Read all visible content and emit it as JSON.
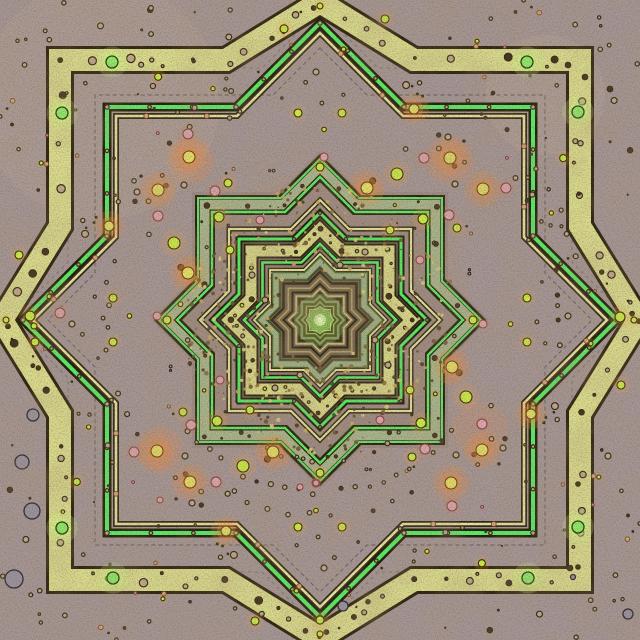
{
  "artwork": {
    "kind": "fractal-star-mandala",
    "canvas": {
      "width": 640,
      "height": 640,
      "background": "#a69797",
      "center": [
        320,
        320
      ]
    },
    "palette": {
      "band_yellow": "#dcdd8f",
      "band_dark_edge": "#2e2410",
      "stripe_green": "#58f168",
      "stripe_pale": "#e9e7a5",
      "sage_band": "#aab78f",
      "faint_line": "rgba(70,58,48,0.5)",
      "core_glow": "#cdf39a",
      "grain_dark": "#1a140a",
      "blotch_brown": "#6b4c2e"
    },
    "glow_patches": [
      [
        450,
        160,
        24,
        "rgba(255,140,60,0.20)"
      ],
      [
        190,
        160,
        24,
        "rgba(255,140,60,0.20)"
      ],
      [
        160,
        450,
        24,
        "rgba(255,140,60,0.18)"
      ],
      [
        480,
        430,
        28,
        "rgba(255,140,60,0.15)"
      ],
      [
        320,
        320,
        150,
        "rgba(200,150,100,0.10)"
      ],
      [
        100,
        100,
        120,
        "rgba(225,205,170,0.10)"
      ],
      [
        545,
        95,
        60,
        "rgba(235,215,180,0.10)"
      ]
    ],
    "tint_fills": [
      {
        "s": 128,
        "r": 169,
        "fill": "rgba(115,92,66,0.16)"
      },
      {
        "s": 78,
        "r": 103,
        "fill": "rgba(105,82,58,0.20)"
      },
      {
        "s": 40,
        "r": 53,
        "fill": "rgba(62,50,28,0.33)"
      }
    ],
    "faint_layers": [
      {
        "s": 225,
        "r": 272,
        "strokes": [
          [
            "rgba(70,58,48,0.5)",
            1.2
          ]
        ],
        "dash": "4 3"
      },
      {
        "s": 252,
        "r": 310,
        "strokes": [
          [
            "rgba(70,58,48,0.35)",
            1.1
          ]
        ],
        "dash": "3 4"
      }
    ],
    "layers": [
      {
        "id": "outer-yellow-band",
        "s": 260,
        "r": 318,
        "w": 94,
        "strokes": [
          [
            "#2e2410",
            28
          ],
          [
            "#dcdd8f",
            22
          ]
        ],
        "banddots": {
          "perEdge": 3,
          "rMin": 1.5,
          "rMax": 4.5
        }
      },
      {
        "id": "green-stripe-1",
        "s": 213,
        "r": 297,
        "strokes": [
          [
            "#1f1c09",
            9
          ],
          [
            "#58f168",
            4
          ]
        ],
        "ticks": "tan"
      },
      {
        "id": "pale-stripe-1",
        "s": 204,
        "r": 287,
        "strokes": [
          [
            "#2e2410",
            6
          ],
          [
            "#e9e7a5",
            2.6
          ]
        ],
        "ticks": "peach"
      },
      {
        "id": "sage-band-1",
        "s": 115,
        "r": 152,
        "strokes": [
          [
            "#2a2110",
            20
          ],
          [
            "#aab78f",
            15.5
          ]
        ],
        "banddots": {
          "perEdge": 1,
          "rMin": 1.4,
          "rMax": 2.6
        }
      },
      {
        "id": "sage-edge-out",
        "s": 122,
        "r": 161,
        "strokes": [
          [
            "rgba(30,28,9,0.8)",
            3.6
          ],
          [
            "#64e870",
            2
          ]
        ]
      },
      {
        "id": "sage-edge-in",
        "s": 108,
        "r": 143,
        "strokes": [
          [
            "#1f1c09",
            5
          ],
          [
            "#5df06a",
            2.4
          ]
        ]
      },
      {
        "id": "pale-stripe-2",
        "s": 91,
        "r": 120,
        "strokes": [
          [
            "#2e2410",
            5
          ],
          [
            "#e6e49e",
            2.2
          ]
        ]
      },
      {
        "id": "green-stripe-2",
        "s": 81,
        "r": 107,
        "strokes": [
          [
            "#1f1c09",
            7
          ],
          [
            "#55ef66",
            3
          ]
        ],
        "ticks": "tiny"
      },
      {
        "id": "yellow-band-2",
        "s": 69,
        "r": 91,
        "strokes": [
          [
            "#2a2110",
            15
          ],
          [
            "#d9d98a",
            11
          ]
        ],
        "banddots": {
          "perEdge": 2,
          "rMin": 0.9,
          "rMax": 2.0
        }
      },
      {
        "id": "green-stripe-3",
        "s": 57.5,
        "r": 76,
        "strokes": [
          [
            "#1f1c09",
            5.6
          ],
          [
            "#5df06a",
            2.6
          ]
        ]
      },
      {
        "id": "pale-stripe-3",
        "s": 50,
        "r": 66,
        "strokes": [
          [
            "#2e2410",
            4.4
          ],
          [
            "#e6e49e",
            1.9
          ]
        ]
      },
      {
        "id": "sage-band-2",
        "s": 44,
        "r": 58,
        "strokes": [
          [
            "#2a2110",
            9
          ],
          [
            "#a3b089",
            6
          ]
        ]
      },
      {
        "id": "sage2-edge-out",
        "s": 47.5,
        "r": 63,
        "strokes": [
          [
            "#4a6a30",
            1.5
          ]
        ]
      },
      {
        "id": "sage2-edge-in",
        "s": 40.5,
        "r": 53.5,
        "strokes": [
          [
            "#4a6a30",
            1.5
          ]
        ]
      }
    ],
    "core": {
      "s0": 36.5,
      "ratio": 0.868,
      "count": 22,
      "r_factor": 1.32,
      "cycle": [
        [
          "#3a2f15",
          2.4
        ],
        [
          "#b3a65c",
          1.6
        ],
        [
          "#30270f",
          2.1
        ],
        [
          "#d2c973",
          1.5
        ],
        [
          "#352b11",
          2.0
        ],
        [
          "#8ba06b",
          1.4
        ]
      ]
    },
    "core_glow": [
      [
        26,
        "rgba(150,205,95,0.30)"
      ],
      [
        13,
        "rgba(175,235,120,0.55)"
      ],
      [
        6,
        "#cdf39a"
      ],
      [
        2.5,
        "#edffd6"
      ]
    ],
    "dot_types": {
      "green_glow": {
        "fill": "#8fee68",
        "ring": "#23400e",
        "rw": 1.3,
        "glow": "rgba(210,255,130,0.40)",
        "gm": 2.6
      },
      "chartreuse": {
        "fill": "#cdef46",
        "ring": "#32280a",
        "rw": 1.1,
        "glow": "rgba(255,170,60,0.28)",
        "gm": 2.2
      },
      "yellow_glow": {
        "fill": "#e9e066",
        "ring": "#5a3c14",
        "rw": 1.0,
        "glow": "rgba(255,140,50,0.38)",
        "gm": 3.0
      },
      "pink": {
        "fill": "#dfa6ae",
        "ring": "#784040",
        "rw": 1.0,
        "glow": "rgba(255,120,80,0.16)",
        "gm": 1.9
      },
      "tan_ring": {
        "fill": "#c2ab8c",
        "ring": "#322714",
        "rw": 1.2
      },
      "peach": {
        "fill": "#dba87c",
        "ring": "#7a4a20",
        "rw": 0.9
      },
      "dark": {
        "fill": "#43321c",
        "ring": "#2a1d0c",
        "rw": 0.6
      },
      "gray": {
        "fill": "#9b93a0",
        "ring": "#2d2a32",
        "rw": 1.3
      }
    },
    "quad_dots": [
      [
        112,
        62,
        6,
        "green_glow"
      ],
      [
        527,
        62,
        6,
        "green_glow"
      ],
      [
        385,
        19,
        4,
        "chartreuse"
      ],
      [
        320,
        6,
        3,
        "chartreuse"
      ],
      [
        189,
        157,
        6,
        "yellow_glow"
      ],
      [
        450,
        158,
        6,
        "yellow_glow"
      ],
      [
        424,
        158,
        5,
        "pink"
      ],
      [
        449,
        215,
        5,
        "pink"
      ],
      [
        457,
        228,
        4,
        "chartreuse"
      ],
      [
        188,
        273,
        6,
        "yellow_glow"
      ],
      [
        157,
        316,
        4,
        "pink"
      ],
      [
        243,
        466,
        6,
        "chartreuse"
      ],
      [
        217,
        421,
        5,
        "chartreuse"
      ],
      [
        134,
        452,
        5,
        "pink"
      ],
      [
        531,
        414,
        5,
        "yellow_glow"
      ],
      [
        527,
        298,
        4,
        "chartreuse"
      ],
      [
        527,
        342,
        4,
        "chartreuse"
      ],
      [
        473,
        320,
        4,
        "chartreuse"
      ],
      [
        568,
        316,
        3,
        "tan_ring"
      ],
      [
        448,
        137,
        3,
        "tan_ring"
      ],
      [
        455,
        184,
        3,
        "tan_ring"
      ],
      [
        365,
        252,
        3,
        "tan_ring"
      ],
      [
        380,
        420,
        4,
        "pink"
      ],
      [
        410,
        390,
        4,
        "chartreuse"
      ],
      [
        300,
        375,
        3,
        "tan_ring"
      ]
    ],
    "solo_dots": [
      [
        620,
        317,
        5,
        "chartreuse"
      ],
      [
        30,
        316,
        5,
        "chartreuse"
      ],
      [
        34,
        326,
        3,
        "chartreuse"
      ],
      [
        35,
        342,
        4,
        "chartreuse"
      ],
      [
        320,
        620,
        4,
        "chartreuse"
      ],
      [
        22,
        462,
        7,
        "gray"
      ],
      [
        33,
        415,
        6,
        "gray"
      ],
      [
        32,
        511,
        8,
        "gray"
      ],
      [
        14,
        579,
        9,
        "gray"
      ],
      [
        628,
        614,
        5,
        "gray"
      ],
      [
        343,
        606,
        5,
        "gray"
      ],
      [
        60,
        313,
        5,
        "pink"
      ],
      [
        608,
        456,
        3,
        "tan_ring"
      ],
      [
        610,
        89,
        3,
        "dark"
      ],
      [
        568,
        65,
        3,
        "dark"
      ],
      [
        585,
        77,
        3,
        "dark"
      ],
      [
        570,
        568,
        3,
        "dark"
      ],
      [
        578,
        567,
        2.5,
        "dark"
      ],
      [
        573,
        577,
        2.5,
        "gray"
      ],
      [
        578,
        484,
        2.5,
        "dark"
      ],
      [
        493,
        93,
        2,
        "dark"
      ],
      [
        436,
        244,
        2.5,
        "dark"
      ],
      [
        160,
        500,
        3,
        "pink"
      ],
      [
        300,
        487,
        3,
        "pink"
      ],
      [
        316,
        483,
        3,
        "pink"
      ]
    ],
    "bead_arcs": [
      {
        "r": 172,
        "a0": 40,
        "a1": 140,
        "n": 22
      },
      {
        "r": 140,
        "a0": 55,
        "a1": 125,
        "n": 12
      },
      {
        "r": 196,
        "a0": 62,
        "a1": 118,
        "n": 10
      },
      {
        "r": 214,
        "a0": 148,
        "a1": 196,
        "n": 9
      },
      {
        "r": 264,
        "a0": -56,
        "a1": -14,
        "n": 9
      },
      {
        "r": 240,
        "a0": -36,
        "a1": 6,
        "n": 8
      },
      {
        "r": 298,
        "a0": 96,
        "a1": 122,
        "n": 6
      },
      {
        "r": 232,
        "a0": 204,
        "a1": 236,
        "n": 6
      }
    ],
    "dot_columns": [
      {
        "x": 152,
        "y0": 8,
        "y1": 86,
        "n": 4
      },
      {
        "x": 230,
        "y0": 10,
        "y1": 118,
        "n": 5
      }
    ],
    "speckle": {
      "seed": 7,
      "count": 520,
      "mMin": 47,
      "mMax": 133,
      "rMin": 0.7,
      "rMax": 2.3,
      "colors": [
        "#6a5230",
        "#8a6a3a",
        "#caa85a",
        "#ddd27a",
        "#4a3820"
      ]
    },
    "scatter": {
      "seed": 13,
      "count": 70,
      "mExclude": 135,
      "rMin": 0.6,
      "rMax": 2.6
    },
    "band_dot_seed": 3,
    "grain": {
      "fine_opacity": 0.5,
      "blotch_opacity": 0.5
    }
  }
}
